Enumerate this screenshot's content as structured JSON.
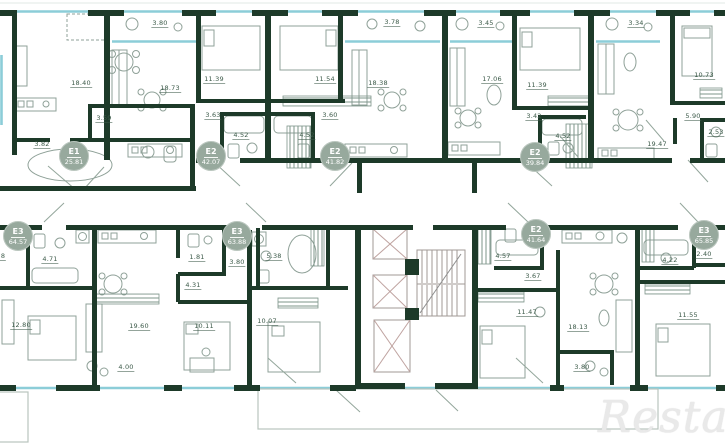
{
  "watermark": "Restate",
  "colors": {
    "wall": "#1d3a29",
    "window": "#8ccdd8",
    "badge": "#97a99d",
    "label": "#3c5a49"
  },
  "rooms": [
    "18.40",
    "3.59",
    "3.82",
    "3.80",
    "18.73",
    "11.39",
    "3.63",
    "4.52",
    "4.52",
    "3.60",
    "11.54",
    "3.78",
    "18.38",
    "3.45",
    "17.06",
    "11.39",
    "3.42",
    "4.52",
    "3.34",
    "10.73",
    "5.90",
    "2.53",
    "19.47",
    "8",
    "4.71",
    "1.81",
    "4.31",
    "12.80",
    "19.60",
    "10.11",
    "4.00",
    "3.80",
    "5.38",
    "10.07",
    "4.57",
    "3.67",
    "11.47",
    "18.13",
    "3.80",
    "4.22",
    "2.40",
    "11.55"
  ],
  "badges": [
    {
      "type": "Е1",
      "area": "25.81"
    },
    {
      "type": "Е2",
      "area": "42.07"
    },
    {
      "type": "Е2",
      "area": "41.82"
    },
    {
      "type": "Е2",
      "area": "39.84"
    },
    {
      "type": "Е3",
      "area": "64.57"
    },
    {
      "type": "Е3",
      "area": "63.88"
    },
    {
      "type": "Е2",
      "area": "41.64"
    },
    {
      "type": "Е3",
      "area": "65.85"
    }
  ]
}
